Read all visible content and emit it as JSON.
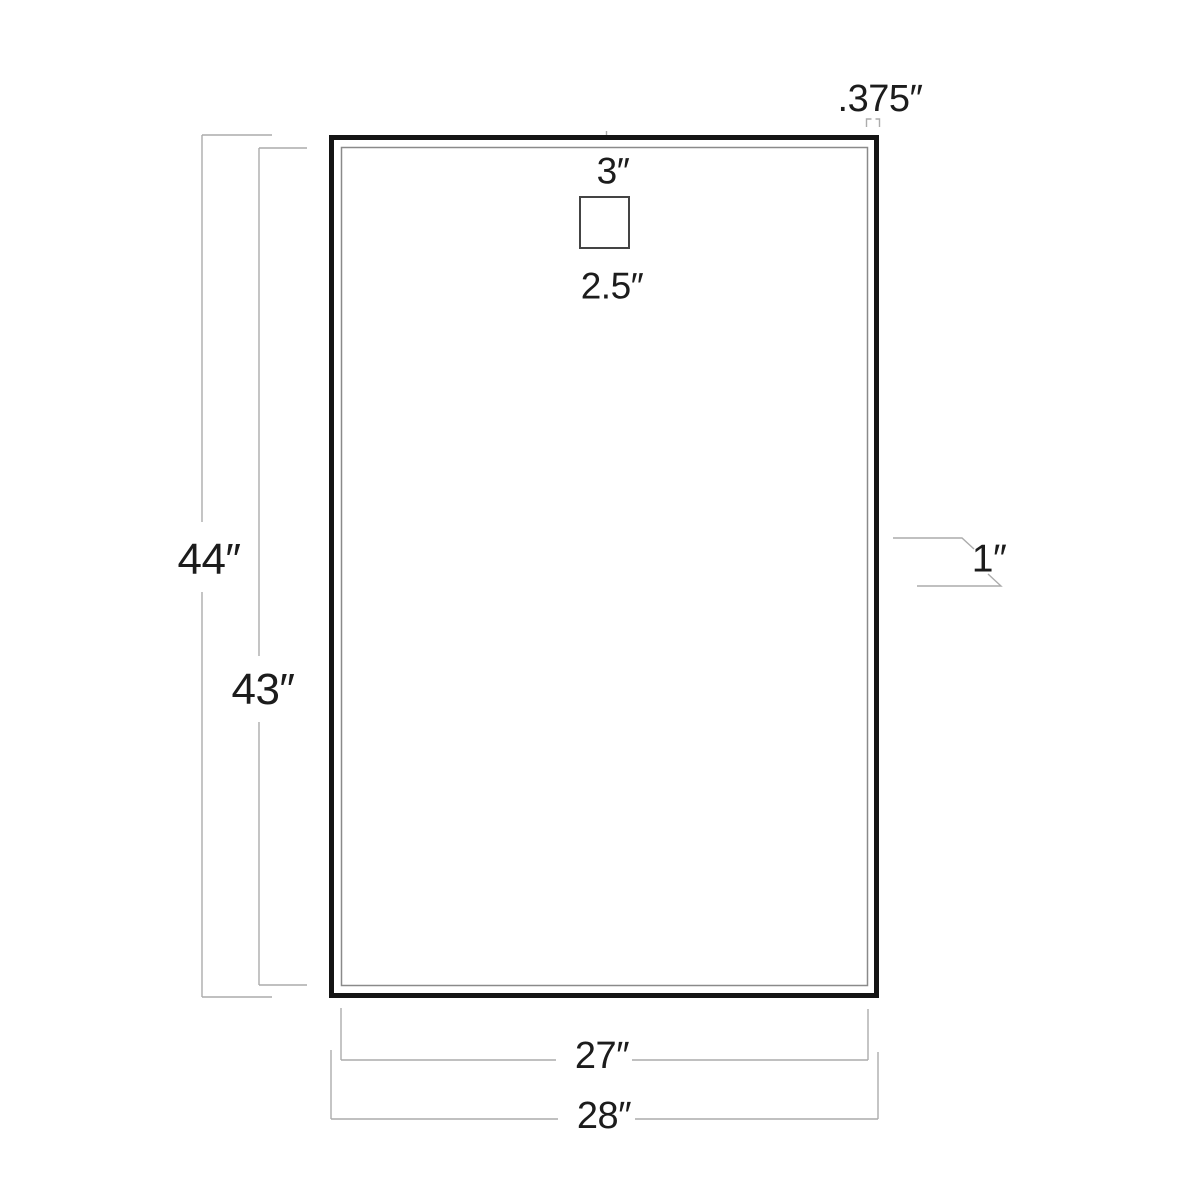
{
  "diagram": {
    "kind": "dimension-diagram",
    "subject": "rectangular framed panel, front view, with top mounting bracket",
    "colors": {
      "background": "#ffffff",
      "outer_frame": "#141414",
      "inner_edge": "#8a8a8a",
      "bracket_outline": "#444444",
      "dimension_lines": "#acacac",
      "label_text": "#1c1c1c"
    },
    "labels": {
      "frame_face_width": ".375″",
      "bracket_offset_top": "3″",
      "bracket_width": "2.5″",
      "overall_height": "44″",
      "inner_height": "43″",
      "frame_depth": "1″",
      "inner_width": "27″",
      "overall_width": "28″"
    }
  }
}
